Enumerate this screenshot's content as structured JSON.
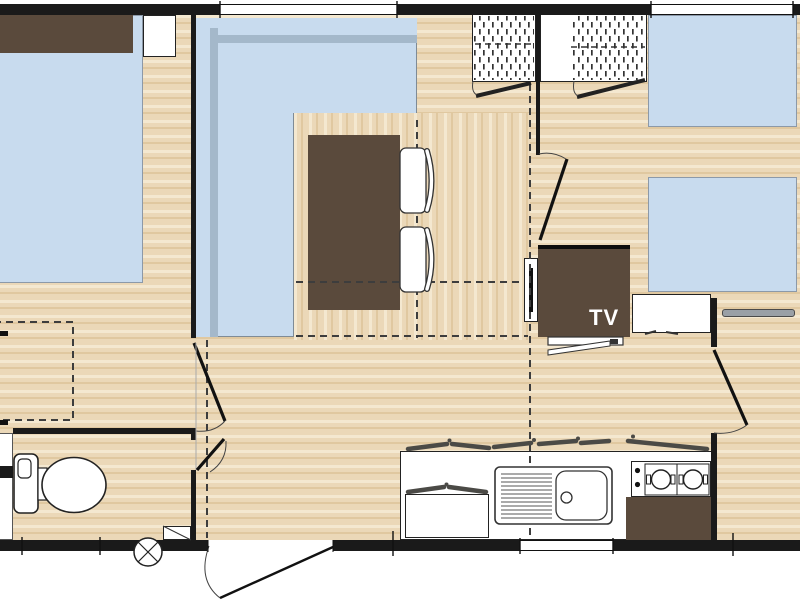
{
  "labels": {
    "tv": "TV"
  },
  "colors": {
    "wall": "#1a1a1a",
    "floor-base": "#ebd8b8",
    "floor-light": "#f4e8d0",
    "floor-dark": "#e0c8a0",
    "furniture-blue": "#c8dbee",
    "furniture-blue-shade": "#a4b8ca",
    "wood-brown": "#5a4a3c",
    "fixture-white": "#ffffff",
    "line-dark": "#222222",
    "shelf-gray": "#9aa0a6"
  },
  "plan": {
    "areas": [
      {
        "name": "master-bedroom",
        "furniture": [
          "double-bed",
          "headboard",
          "nightstand",
          "storage-dashed-zone"
        ]
      },
      {
        "name": "bathroom",
        "furniture": [
          "toilet",
          "corner-unit",
          "vent-step-circle"
        ]
      },
      {
        "name": "living-dining",
        "furniture": [
          "corner-sofa",
          "dining-table",
          "chair",
          "chair",
          "tv-cabinet",
          "tv-shelf",
          "radiator",
          "wardrobe",
          "wardrobe"
        ]
      },
      {
        "name": "kitchen",
        "furniture": [
          "counter",
          "under-counter-cabinet",
          "sink-with-drainboard",
          "hob-2-burner",
          "hob-cabinet"
        ]
      },
      {
        "name": "twin-bedroom",
        "furniture": [
          "single-bed",
          "single-bed",
          "foot-cabinet",
          "wall-shelf"
        ]
      }
    ],
    "openings": [
      "entrance-door",
      "master-bedroom-door",
      "bathroom-door",
      "hallway-door",
      "twin-bedroom-door",
      "wardrobe-door-left",
      "wardrobe-door-right",
      "window-top-left",
      "window-top-right",
      "window-kitchen",
      "window-bedroom-left-wall"
    ]
  }
}
